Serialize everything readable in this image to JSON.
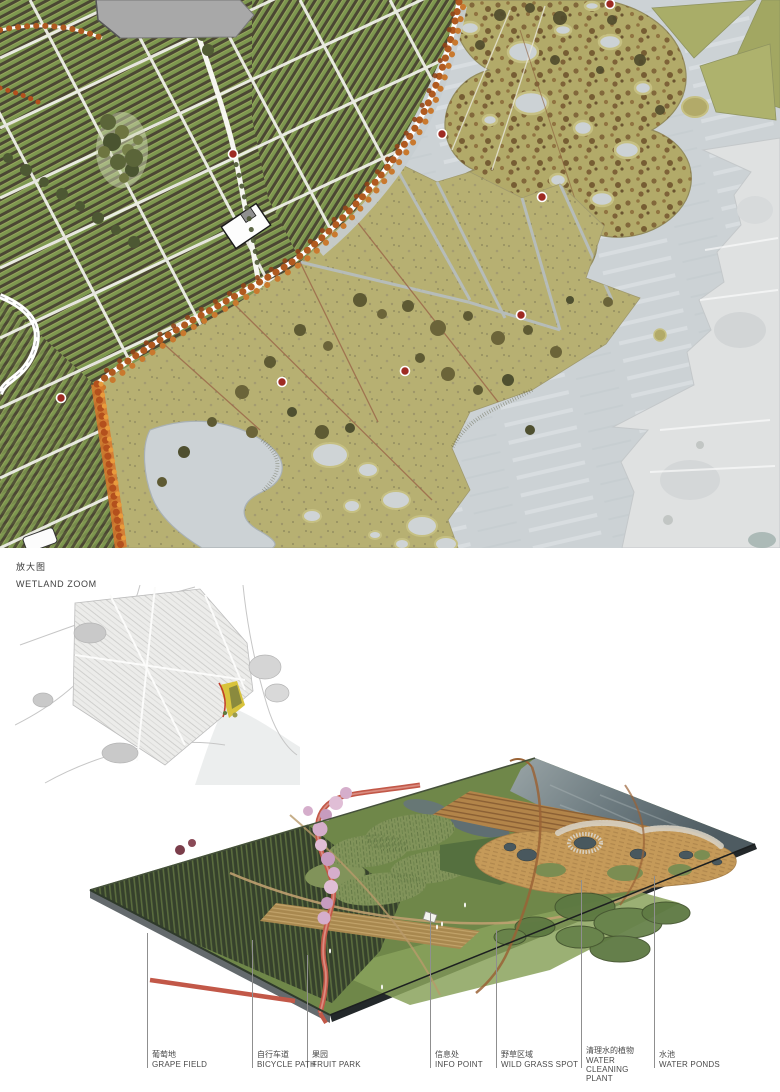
{
  "page": {
    "width": 780,
    "height": 1092,
    "background": "#ffffff"
  },
  "masterplan": {
    "description": "vineyard and wetland masterplan",
    "palette": {
      "water": "#ccd2d5",
      "wave_light": "#e3e8ea",
      "vineyard_green": "#7d974f",
      "vine_row_dark": "#4b4733",
      "road_white": "#f4f4ee",
      "autumn_tree_orange": "#b05a20",
      "autumn_tree_light": "#c9792e",
      "wetland_island_olive": "#b2aa69",
      "island_speckle_brown": "#7a5c33",
      "meadow_tan": "#b7b072",
      "existing_land_gray": "#dfe1e1",
      "info_point_red": "#9e2b23"
    },
    "info_point_count": 8
  },
  "zoom_section": {
    "title_cn": "放大图",
    "title_en": "WETLAND ZOOM",
    "leader_color": "#8f8f8f",
    "labels": [
      {
        "cn": "葡萄地",
        "en": "GRAPE FIELD"
      },
      {
        "cn": "自行车道",
        "en": "BICYCLE PATH"
      },
      {
        "cn": "果园",
        "en": "FRUIT PARK"
      },
      {
        "cn": "信息处",
        "en": "INFO POINT"
      },
      {
        "cn": "野草区域",
        "en": "WILD GRASS SPOT"
      },
      {
        "cn": "清理水的植物",
        "en": "WATER CLEANING PLANT"
      },
      {
        "cn": "水池",
        "en": "WATER PONDS"
      }
    ]
  },
  "axon": {
    "palette": {
      "water_dark": "#4e5b61",
      "meadow_green": "#6f8749",
      "vineyard_dark": "#36412c",
      "bike_path_red": "#c25848",
      "blossom_pink": "#d5aecb",
      "reed_tan": "#c59a59",
      "pond_dark": "#49585e"
    }
  }
}
